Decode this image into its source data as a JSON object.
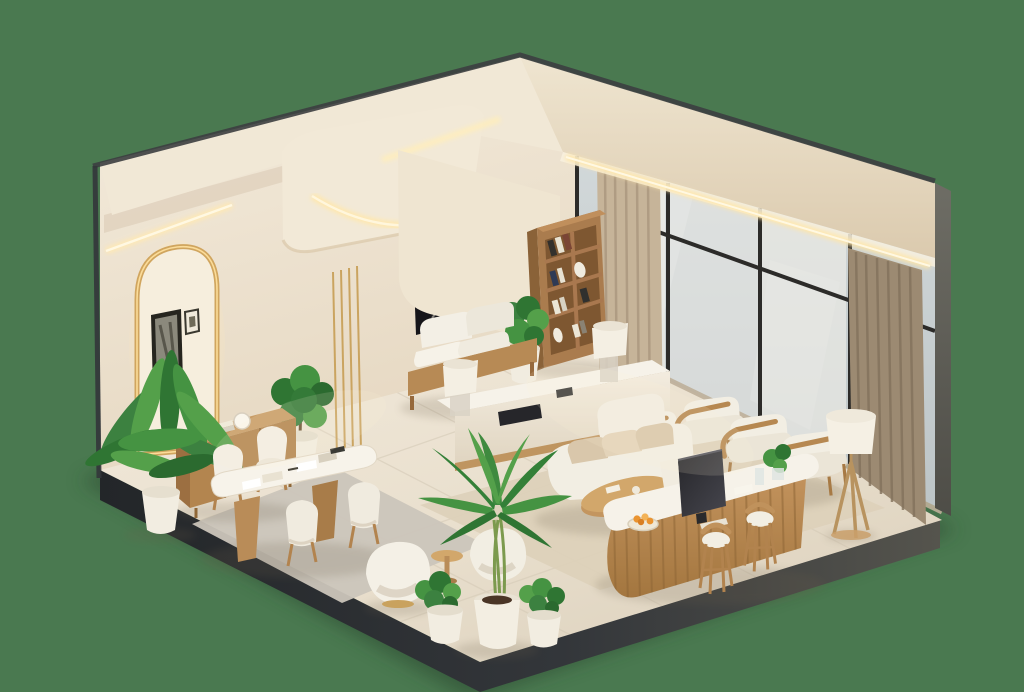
{
  "scene": {
    "title": "Isometric 3D render of a modern cream interior lounge",
    "style": "minimalist warm beige office lounge / reception, cutaway isometric view on solid green backdrop",
    "palette": {
      "background": "#4a7950",
      "floor": "#eae1d1",
      "wall": "#f0e7d7",
      "ceiling": "#f1e8d6",
      "baseDark": "#2b2e31",
      "edgeDark": "#3c3e40",
      "wood": "#b3854f",
      "woodLight": "#c59a66",
      "woodDark": "#8f6737",
      "upholstery": "#f2eee3",
      "cushion": "#d9c7ab",
      "brass": "#c79e55",
      "ledGlow": "#ffe6a8",
      "glass": "#ccd5d8",
      "mullion": "#2c2b29",
      "drapeLight": "#c6b499",
      "drapeDark": "#9c8a72",
      "rugGray": "#cbc5ba",
      "rugBeige": "#ddd0b9",
      "leaf": "#459342",
      "leafDark": "#2f7533",
      "leafLight": "#54a04a",
      "screen": "#2c2c30",
      "fruit": "#ea9430"
    },
    "objects": [
      "green studio backdrop",
      "tiled cream floor platform with dark cutaway base",
      "left wall with gold-trimmed LED arch niche",
      "two framed pictures",
      "ceiling cove LED strip lighting",
      "curved ceiling canopy soffit with LED",
      "LED-lit beam above window wall",
      "glass window wall with black mullions",
      "sheer curtains and beige drapes",
      "wooden bookshelf with books and vases",
      "dark wall-mounted screen artwork",
      "gold decorative rods",
      "wood bench sofa with white cushions",
      "long white media console with two table lamps",
      "wooden credenza with books and sphere lamp",
      "potted fern",
      "fiddle-leaf potted plant",
      "meeting table with four white chairs on gray rug",
      "white boucle lounge chairs",
      "areca palm and two small potted plants in white pots",
      "side table",
      "white sofa with beige cushions",
      "oval wooden coffee table",
      "three wood-frame armchairs",
      "floor lamp with drum shade",
      "laptop on white cabinet",
      "reception desk with fluted wood base and white top",
      "desktop monitor and fruit bowl",
      "two wooden bar stools",
      "beige area rug"
    ]
  }
}
